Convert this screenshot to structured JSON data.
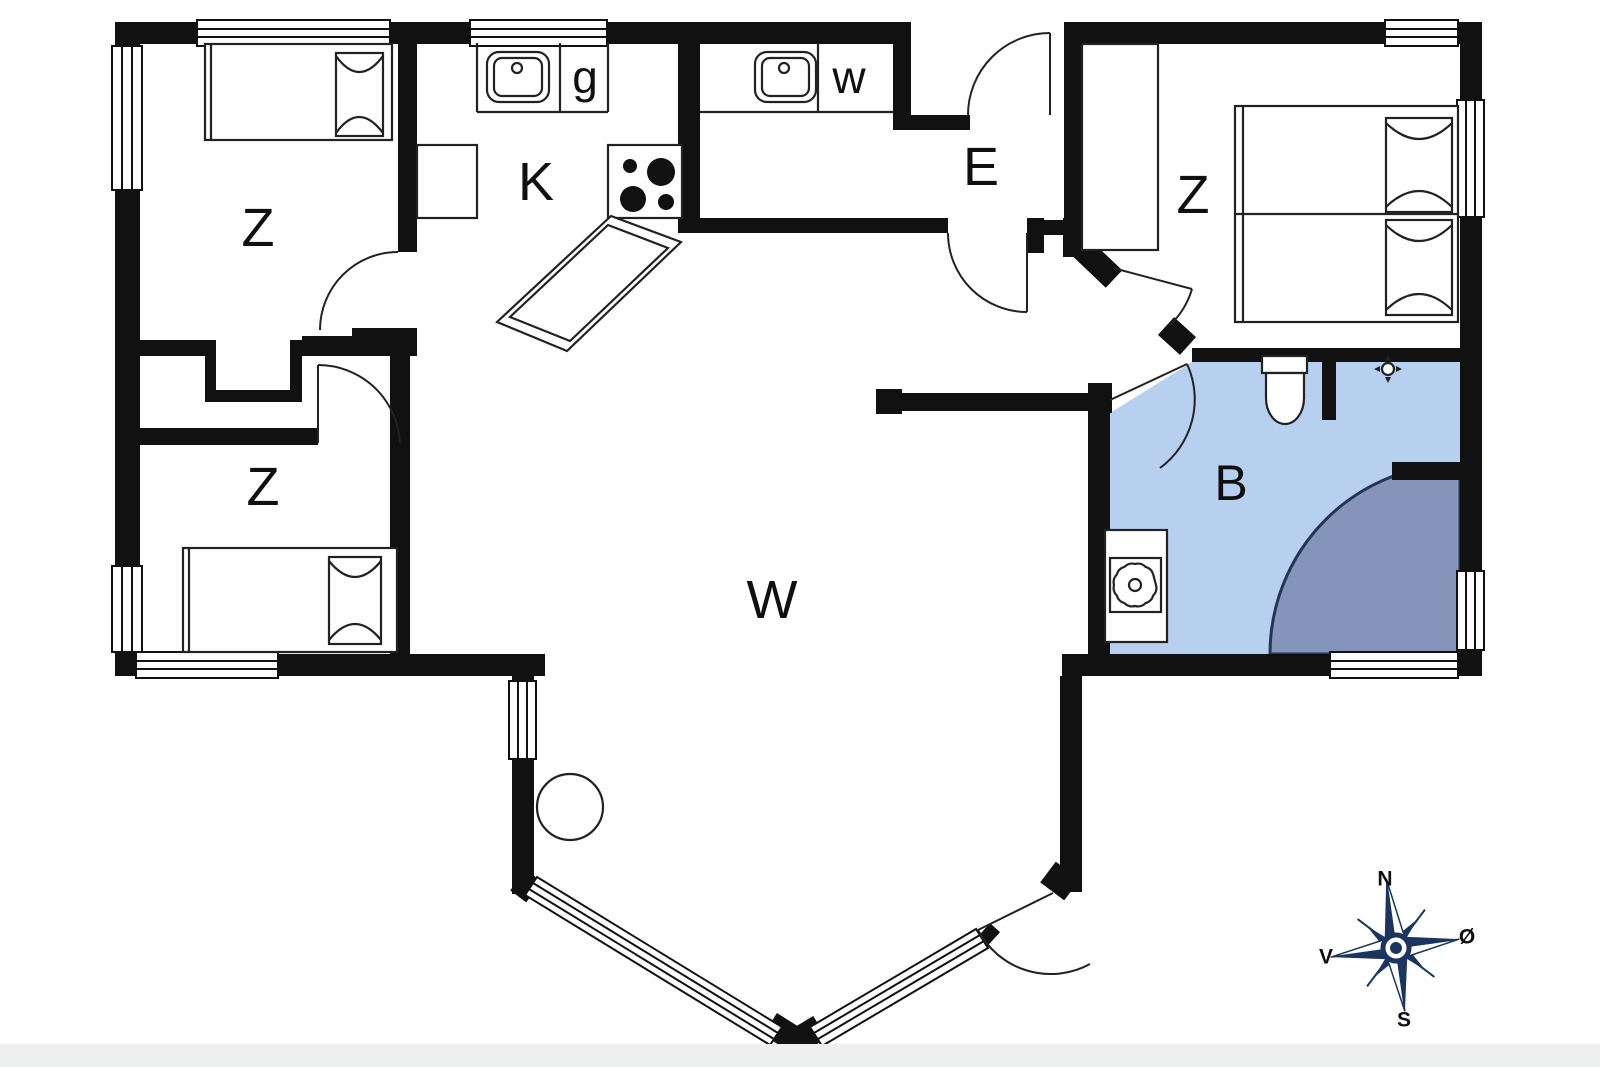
{
  "title": "Holiday house floor plan",
  "colors": {
    "wall": "#111111",
    "line": "#222222",
    "bathroom_floor": "#b7d0f0",
    "shower": "#8494ba",
    "shower_outline": "#233457",
    "compass_navy": "#1b3560",
    "compass_text": "#10284f",
    "outside_band": "#eef0ef"
  },
  "rooms": {
    "bedroom_top_left": {
      "label": "Z"
    },
    "bedroom_bottom_left": {
      "label": "Z"
    },
    "bedroom_right": {
      "label": "Z"
    },
    "kitchen": {
      "label": "K"
    },
    "sink_room_g": {
      "label": "g"
    },
    "sink_room_w": {
      "label": "w"
    },
    "entry": {
      "label": "E"
    },
    "living_room": {
      "label": "W"
    },
    "bathroom": {
      "label": "B"
    }
  },
  "compass": {
    "north": "N",
    "south": "S",
    "west": "V",
    "east": "Ø"
  },
  "icons": {
    "sink": "sink-icon",
    "stove": "stove-burners-icon",
    "toilet": "toilet-icon",
    "shower": "shower-corner-icon",
    "washing_machine": "washing-machine-icon",
    "floor_drain": "floor-drain-icon",
    "round_table": "round-table-icon",
    "compass_rose": "compass-rose-icon"
  }
}
